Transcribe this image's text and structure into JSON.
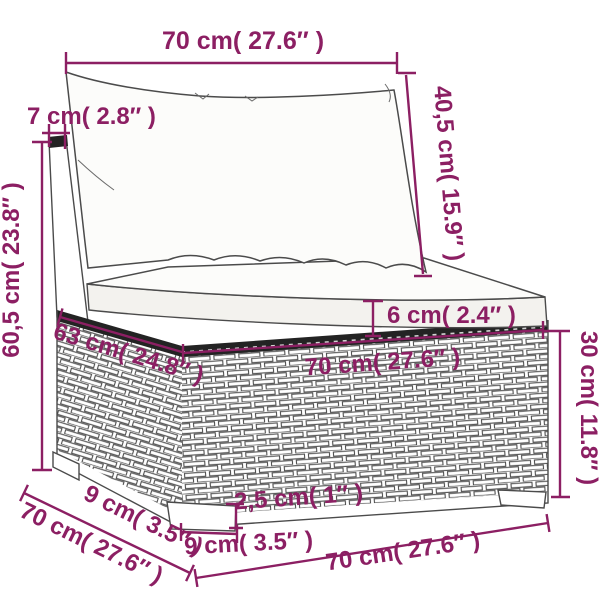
{
  "title": "Rattan sofa middle section dimension diagram",
  "colors": {
    "accent": "#8c1f63",
    "line": "#4b4b4b",
    "background": "#ffffff"
  },
  "labels": {
    "width_top": "70 cm( 27.6″ )",
    "back_frame_thickness": "7 cm( 2.8″ )",
    "back_cushion_height": "40,5 cm( 15.9″ )",
    "overall_height": "60,5 cm( 23.8″ )",
    "seat_cushion_thickness": "6 cm( 2.4″ )",
    "seat_top_depth": "63 cm( 24.8″ )",
    "seat_front_width": "70 cm( 27.6″ )",
    "base_height": "30 cm( 11.8″ )",
    "foot_side_width": "9 cm( 3.5″ )",
    "depth_bottom": "70 cm( 27.6″ )",
    "foot_height": "2,5 cm( 1″ )",
    "foot_front_width": "9 cm( 3.5″ )",
    "width_bottom": "70 cm( 27.6″ )"
  }
}
